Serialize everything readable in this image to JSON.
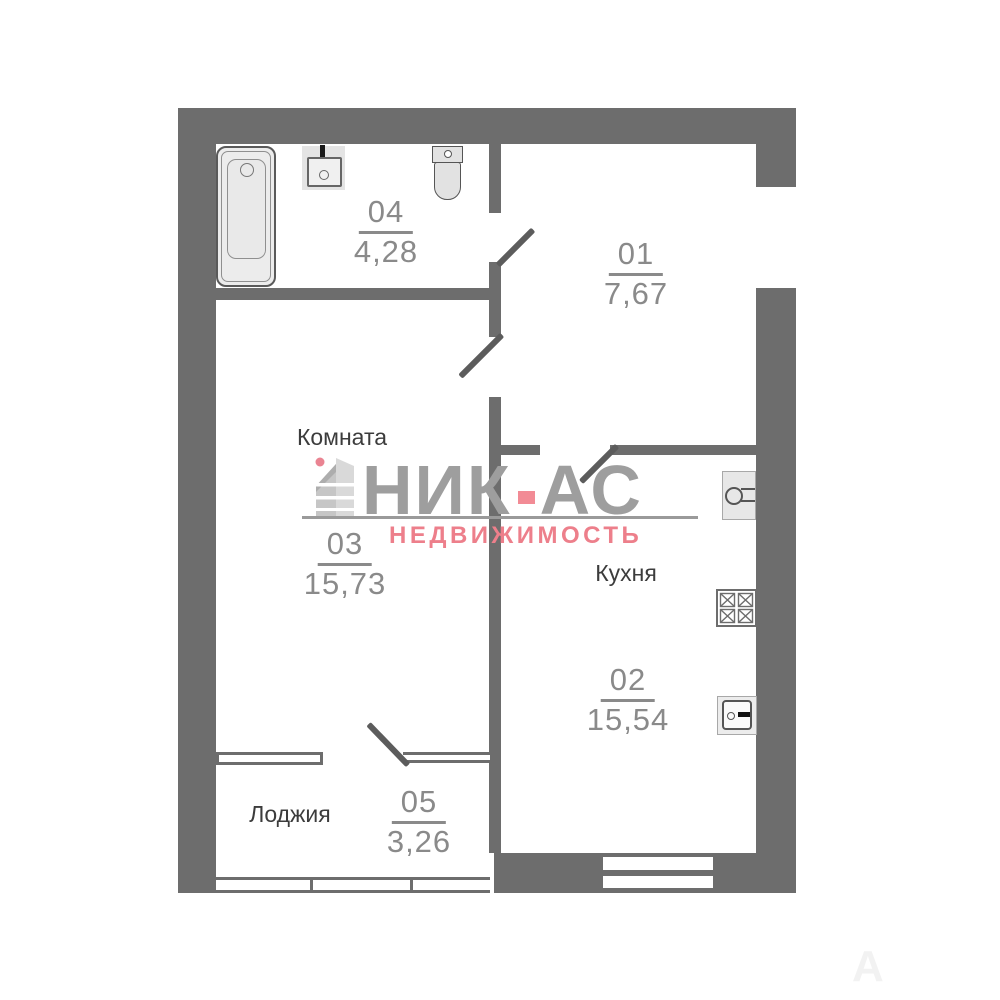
{
  "logo": {
    "brand_left": "НИК",
    "brand_right": "АС",
    "tagline": "НЕДВИЖИМОСТЬ",
    "accent_color": "#ed7f8b",
    "text_color": "#9e9e9e"
  },
  "rooms": {
    "hallway": {
      "number": "01",
      "area": "7,67"
    },
    "kitchen": {
      "number": "02",
      "area": "15,54",
      "label": "Кухня"
    },
    "living": {
      "number": "03",
      "area": "15,73",
      "label": "Комната"
    },
    "bathroom": {
      "number": "04",
      "area": "4,28"
    },
    "loggia": {
      "number": "05",
      "area": "3,26",
      "label": "Лоджия"
    }
  },
  "colors": {
    "wall": "#6d6d6d",
    "number_text": "#8a8a8a",
    "label_text": "#3c3c3c"
  },
  "faint_watermark": "А А"
}
